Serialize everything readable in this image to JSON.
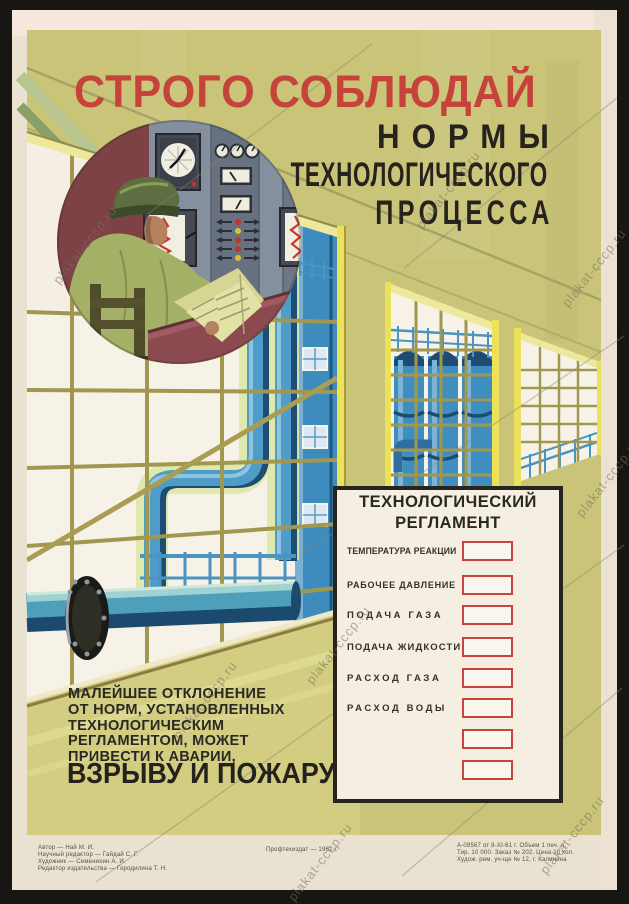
{
  "title": {
    "main": "СТРОГО СОБЛЮДАЙ",
    "sub1": "НОРМЫ",
    "sub2": "ТЕХНОЛОГИЧЕСКОГО",
    "sub3": "ПРОЦЕССА"
  },
  "board": {
    "title1": "ТЕХНОЛОГИЧЕСКИЙ",
    "title2": "РЕГЛАМЕНТ",
    "rows": [
      {
        "label": "ТЕМПЕРАТУРА РЕАКЦИИ"
      },
      {
        "label": "РАБОЧЕЕ ДАВЛЕНИЕ"
      },
      {
        "label": "ПОДАЧА ГАЗА"
      },
      {
        "label": "ПОДАЧА ЖИДКОСТИ"
      },
      {
        "label": "РАСХОД ГАЗА"
      },
      {
        "label": "РАСХОД ВОДЫ"
      }
    ],
    "empty_box_count": 2
  },
  "warning": {
    "lines": [
      "МАЛЕЙШЕЕ ОТКЛОНЕНИЕ",
      "ОТ НОРМ, УСТАНОВЛЕННЫХ",
      "ТЕХНОЛОГИЧЕСКИМ",
      "РЕГЛАМЕНТОМ, МОЖЕТ",
      "ПРИВЕСТИ К АВАРИИ,"
    ],
    "emphasis": "ВЗРЫВУ И ПОЖАРУ"
  },
  "imprint": {
    "left": [
      "Автор — Най М. И.",
      "Научный редактор — Гайдай С. Г.",
      "Художник — Семенихин А. И.",
      "Редактор издательства — Городилина Т. Н."
    ],
    "center": "Профтехиздат — 1962 г.",
    "right": [
      "А-09567 от 8-XI-61 г. Объем 1 печ. л.",
      "Тир. 10 000. Заказ № 202. Цена 10 коп.",
      "Худож. рем. уч-ще № 12, г. Калинина"
    ]
  },
  "watermark": {
    "text": "plakat-cccp.ru"
  },
  "colors": {
    "accent_red": "#c5433b",
    "box_red": "#c6443c",
    "khaki": "#c9c478",
    "blue": "#3f8ec0",
    "maroon": "#7d4146",
    "paper_cream": "#eae2d0",
    "board_bg": "#f4efe2"
  }
}
